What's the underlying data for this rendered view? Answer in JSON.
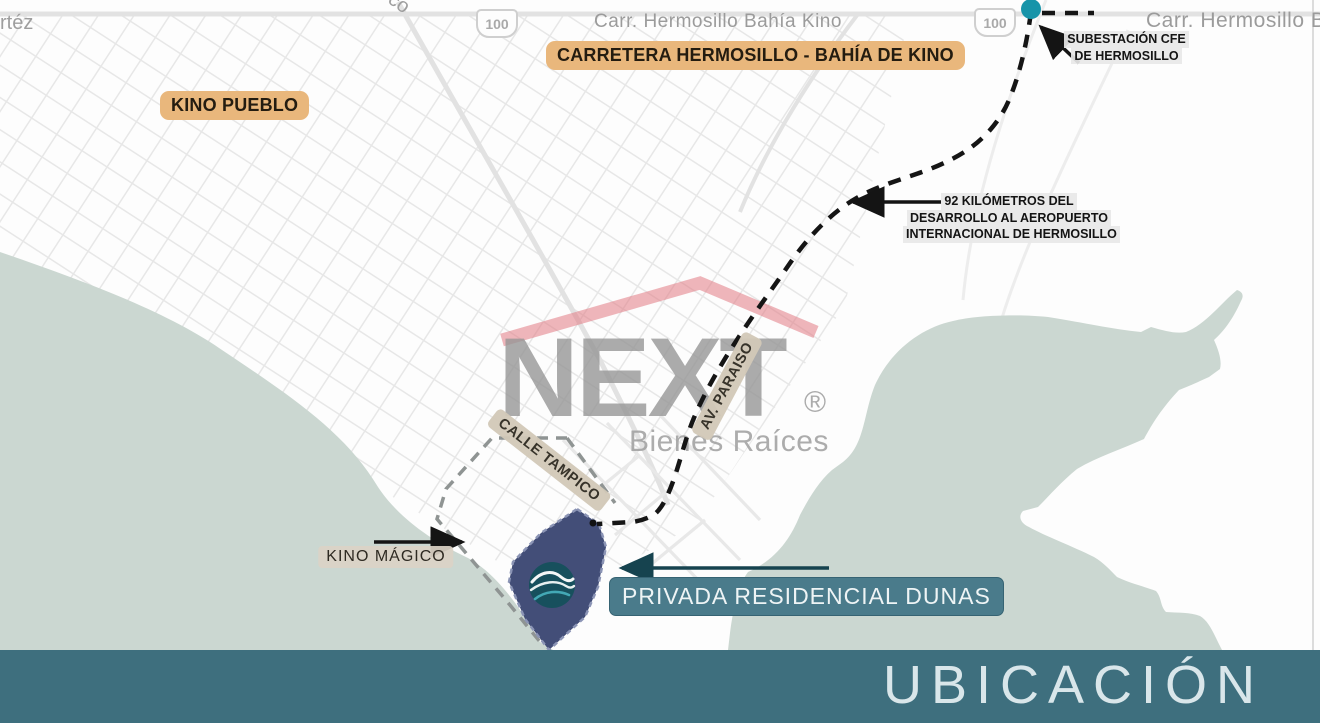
{
  "colors": {
    "water": "#cbd7d1",
    "footer_bar": "#3e6f7e",
    "banner_bg": "#4a7b8b",
    "banner_arrow": "#16434f",
    "site_polygon": "#434e78",
    "logo_circle": "#17505d",
    "accent_orange": "#e9b77c",
    "tan_label": "#d2c8b7",
    "route": "#151515",
    "teal_dot": "#1794a9",
    "watermark_red": "#e27a84",
    "watermark_gray": "#9a9a9a"
  },
  "map": {
    "top_road_label": "Carr. Hermosillo Bahía Kino",
    "top_road_label_right": "Carr. Hermosillo Ba",
    "edge_label_left": "rtéz",
    "edge_label_small": "co",
    "highway_shield_left": "100",
    "highway_shield_right": "100"
  },
  "annotations": {
    "carretera_banner": "CARRETERA HERMOSILLO - BAHÍA DE KINO",
    "kino_pueblo": "KINO PUEBLO",
    "subestacion": {
      "line1": "SUBESTACIÓN CFE",
      "line2": "DE HERMOSILLO"
    },
    "distance": {
      "line1": "92 KILÓMETROS DEL",
      "line2": "DESARROLLO AL AEROPUERTO",
      "line3": "INTERNACIONAL DE HERMOSILLO"
    },
    "calle_tampico": "CALLE TAMPICO",
    "av_paraiso": "AV. PARAISO",
    "kino_magico": "KINO MÁGICO",
    "site_banner": "PRIVADA RESIDENCIAL DUNAS"
  },
  "watermark": {
    "brand": "NEXT",
    "registered": "®",
    "tagline": "Bienes Raíces"
  },
  "footer": {
    "title": "UBICACIÓN"
  }
}
